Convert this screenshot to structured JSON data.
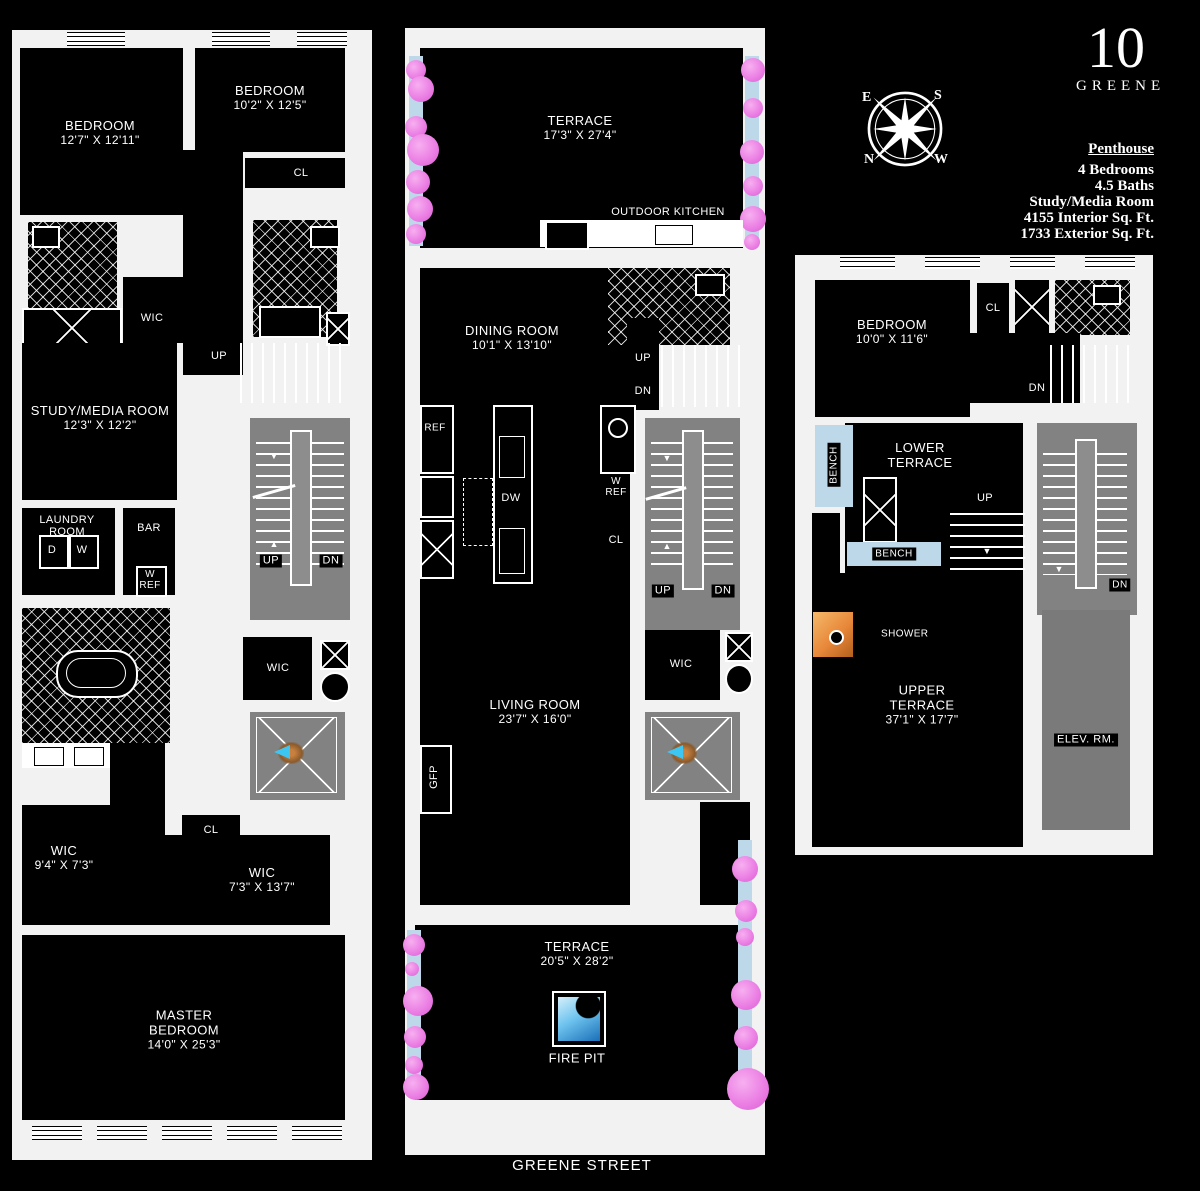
{
  "brand": {
    "number": "10",
    "name": "GREENE"
  },
  "info": {
    "title": "Penthouse",
    "lines": [
      "4 Bedrooms",
      "4.5 Baths",
      "Study/Media Room",
      "4155 Interior Sq. Ft.",
      "1733 Exterior Sq. Ft."
    ]
  },
  "compass": {
    "e": "E",
    "s": "S",
    "n": "N",
    "w": "W"
  },
  "street": "GREENE STREET",
  "colors": {
    "background": "#000000",
    "walls": "#f2f2f2",
    "stair_core_gray": "#828282",
    "planter_blue": "#bdd9e9",
    "plant_pink": "#ea7ce3",
    "skylight_arrow_cyan": "#3ec6f2",
    "shower_orange": "#e8883a",
    "firepit_blue": "#6fc4ef"
  },
  "left_plan": {
    "bedroom1_name": "BEDROOM",
    "bedroom1_dims": "12'7\" X 12'11\"",
    "bedroom2_name": "BEDROOM",
    "bedroom2_dims": "10'2\" X 12'5\"",
    "cl1": "CL",
    "wic1": "WIC",
    "study_name": "STUDY/MEDIA ROOM",
    "study_dims": "12'3\" X 12'2\"",
    "up_top": "UP",
    "stair_up": "UP",
    "stair_dn": "DN",
    "laundry1": "LAUNDRY",
    "laundry2": "ROOM",
    "d": "D",
    "w": "W",
    "bar": "BAR",
    "wref1": "W",
    "wref2": "REF",
    "wic2": "WIC",
    "cl3": "CL",
    "wic3_name": "WIC",
    "wic3_dims": "9'4\" X 7'3\"",
    "wic4_name": "WIC",
    "wic4_dims": "7'3\" X 13'7\"",
    "master1": "MASTER",
    "master2": "BEDROOM",
    "master_dims": "14'0\" X 25'3\""
  },
  "middle_plan": {
    "terrace_top_name": "TERRACE",
    "terrace_top_dims": "17'3\" X 27'4\"",
    "outdoor_kitchen": "OUTDOOR KITCHEN",
    "dining_name": "DINING ROOM",
    "dining_dims": "10'1\" X 13'10\"",
    "up": "UP",
    "dn": "DN",
    "ref": "REF",
    "dw": "DW",
    "wref1": "W",
    "wref2": "REF",
    "cl": "CL",
    "stair_up": "UP",
    "stair_dn": "DN",
    "living_name": "LIVING ROOM",
    "living_dims": "23'7\" X 16'0\"",
    "gfp": "GFP",
    "wic": "WIC",
    "terrace_bottom_name": "TERRACE",
    "terrace_bottom_dims": "20'5\" X 28'2\"",
    "fire_pit": "FIRE PIT"
  },
  "right_plan": {
    "bedroom_name": "BEDROOM",
    "bedroom_dims": "10'0\" X 11'6\"",
    "cl": "CL",
    "dn_top": "DN",
    "lower1": "LOWER",
    "lower2": "TERRACE",
    "bench1": "BENCH",
    "bench2": "BENCH",
    "up": "UP",
    "stair_dn": "DN",
    "shower": "SHOWER",
    "upper1": "UPPER",
    "upper2": "TERRACE",
    "upper_dims": "37'1\" X 17'7\"",
    "elev": "ELEV. RM."
  }
}
